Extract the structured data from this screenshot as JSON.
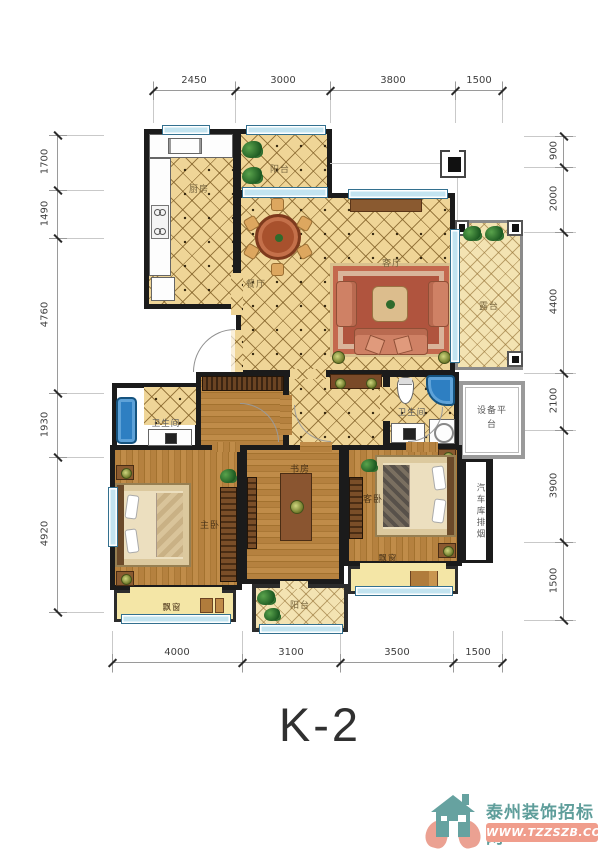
{
  "title": "K-2",
  "dimensions": {
    "top": [
      "2450",
      "3000",
      "3800",
      "1500"
    ],
    "bottom": [
      "4000",
      "3100",
      "3500",
      "1500"
    ],
    "left": [
      "1700",
      "1490",
      "4760",
      "1930",
      "4920"
    ],
    "right": [
      "900",
      "2000",
      "4400",
      "2100",
      "3900",
      "1500"
    ]
  },
  "rooms": {
    "kitchen": "厨房",
    "balcony_top": "阳台",
    "dining": "餐厅",
    "living": "客厅",
    "terrace": "露台",
    "bath_main": "卫生间",
    "bath_second": "卫生间",
    "master_bedroom": "主卧",
    "study": "书房",
    "guest_bedroom": "客卧",
    "balcony_bottom": "阳台",
    "bay_master": "飘窗",
    "bay_guest": "飘窗",
    "equipment_platform": "设备平台",
    "garage_flue": "汽车库排烟"
  },
  "watermark": {
    "site_name": "泰州装饰招标网",
    "site_url": "WWW.TZZSZB.COM"
  },
  "colors": {
    "wall": "#1b1b1b",
    "tile_floor": "#efd597",
    "wood_floor": "#b5813f",
    "fixture_blue": "#2e7fc2",
    "window_blue": "#c3e4f0",
    "logo_teal": "#5f9e9b",
    "logo_salmon": "#f09d8c"
  }
}
